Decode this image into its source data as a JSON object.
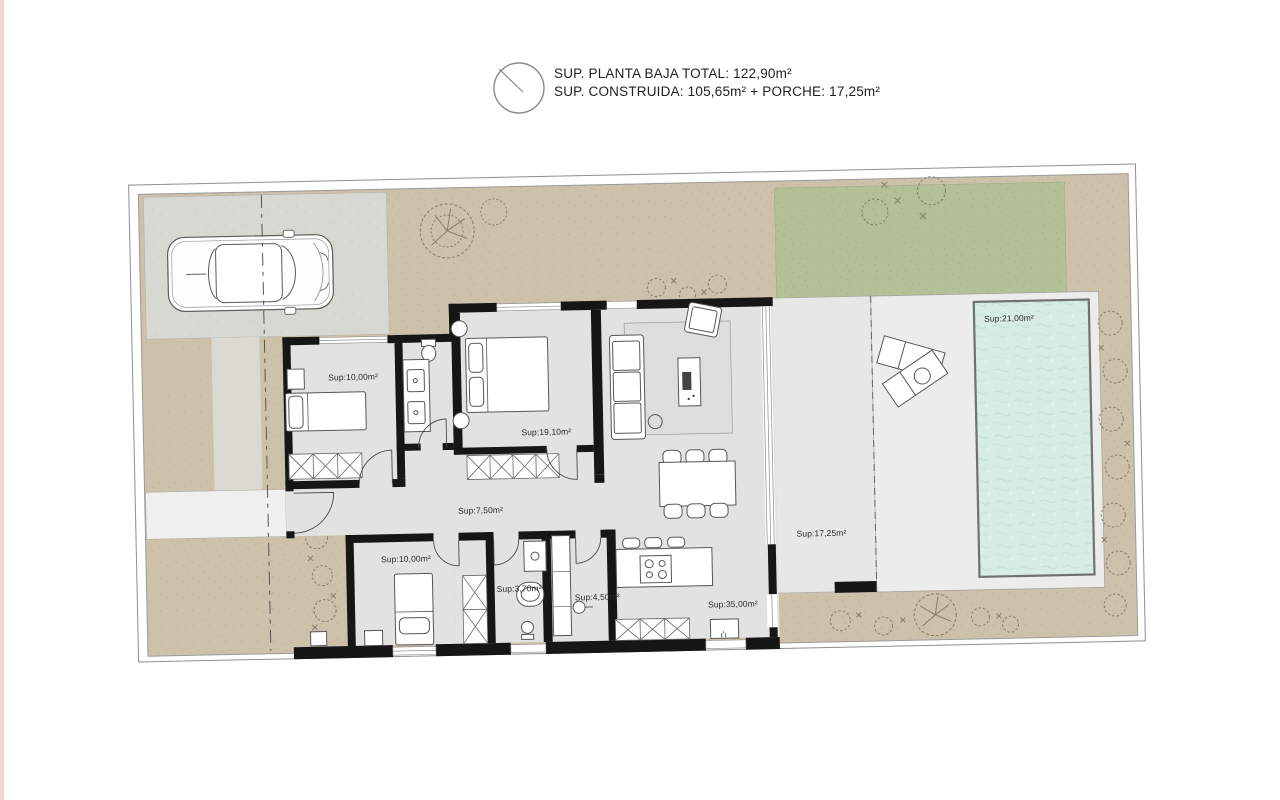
{
  "header": {
    "line1": "SUP. PLANTA BAJA TOTAL: 122,90m²",
    "line2": "SUP. CONSTRUIDA: 105,65m² + PORCHE: 17,25m²"
  },
  "rooms": [
    {
      "name": "bedroom-1",
      "area_label": "Sup:10,00m²"
    },
    {
      "name": "master-bedroom",
      "area_label": "Sup:19,10m²"
    },
    {
      "name": "hallway",
      "area_label": "Sup:7,50m²"
    },
    {
      "name": "bedroom-2",
      "area_label": "Sup:10,00m²"
    },
    {
      "name": "bathroom-1",
      "area_label": "Sup:3,70m²"
    },
    {
      "name": "bathroom-2",
      "area_label": "Sup:4,50m²"
    },
    {
      "name": "kitchen-living",
      "area_label": "Sup:35,00m²"
    },
    {
      "name": "porch",
      "area_label": "Sup:17,25m²"
    },
    {
      "name": "pool",
      "area_label": "Sup:21,00m²"
    }
  ],
  "colors": {
    "ground_tan": "#cec1aa",
    "driveway_gray": "#d6d8d1",
    "grass_green": "#b3c098",
    "pool_teal": "#d8ece5",
    "terrace_light": "#ecedeb",
    "porch_light": "#e7e8e5",
    "house_floor": "#e2e3e1",
    "wall_black": "#161616",
    "page_edge_pink": "#e9c6c2"
  }
}
